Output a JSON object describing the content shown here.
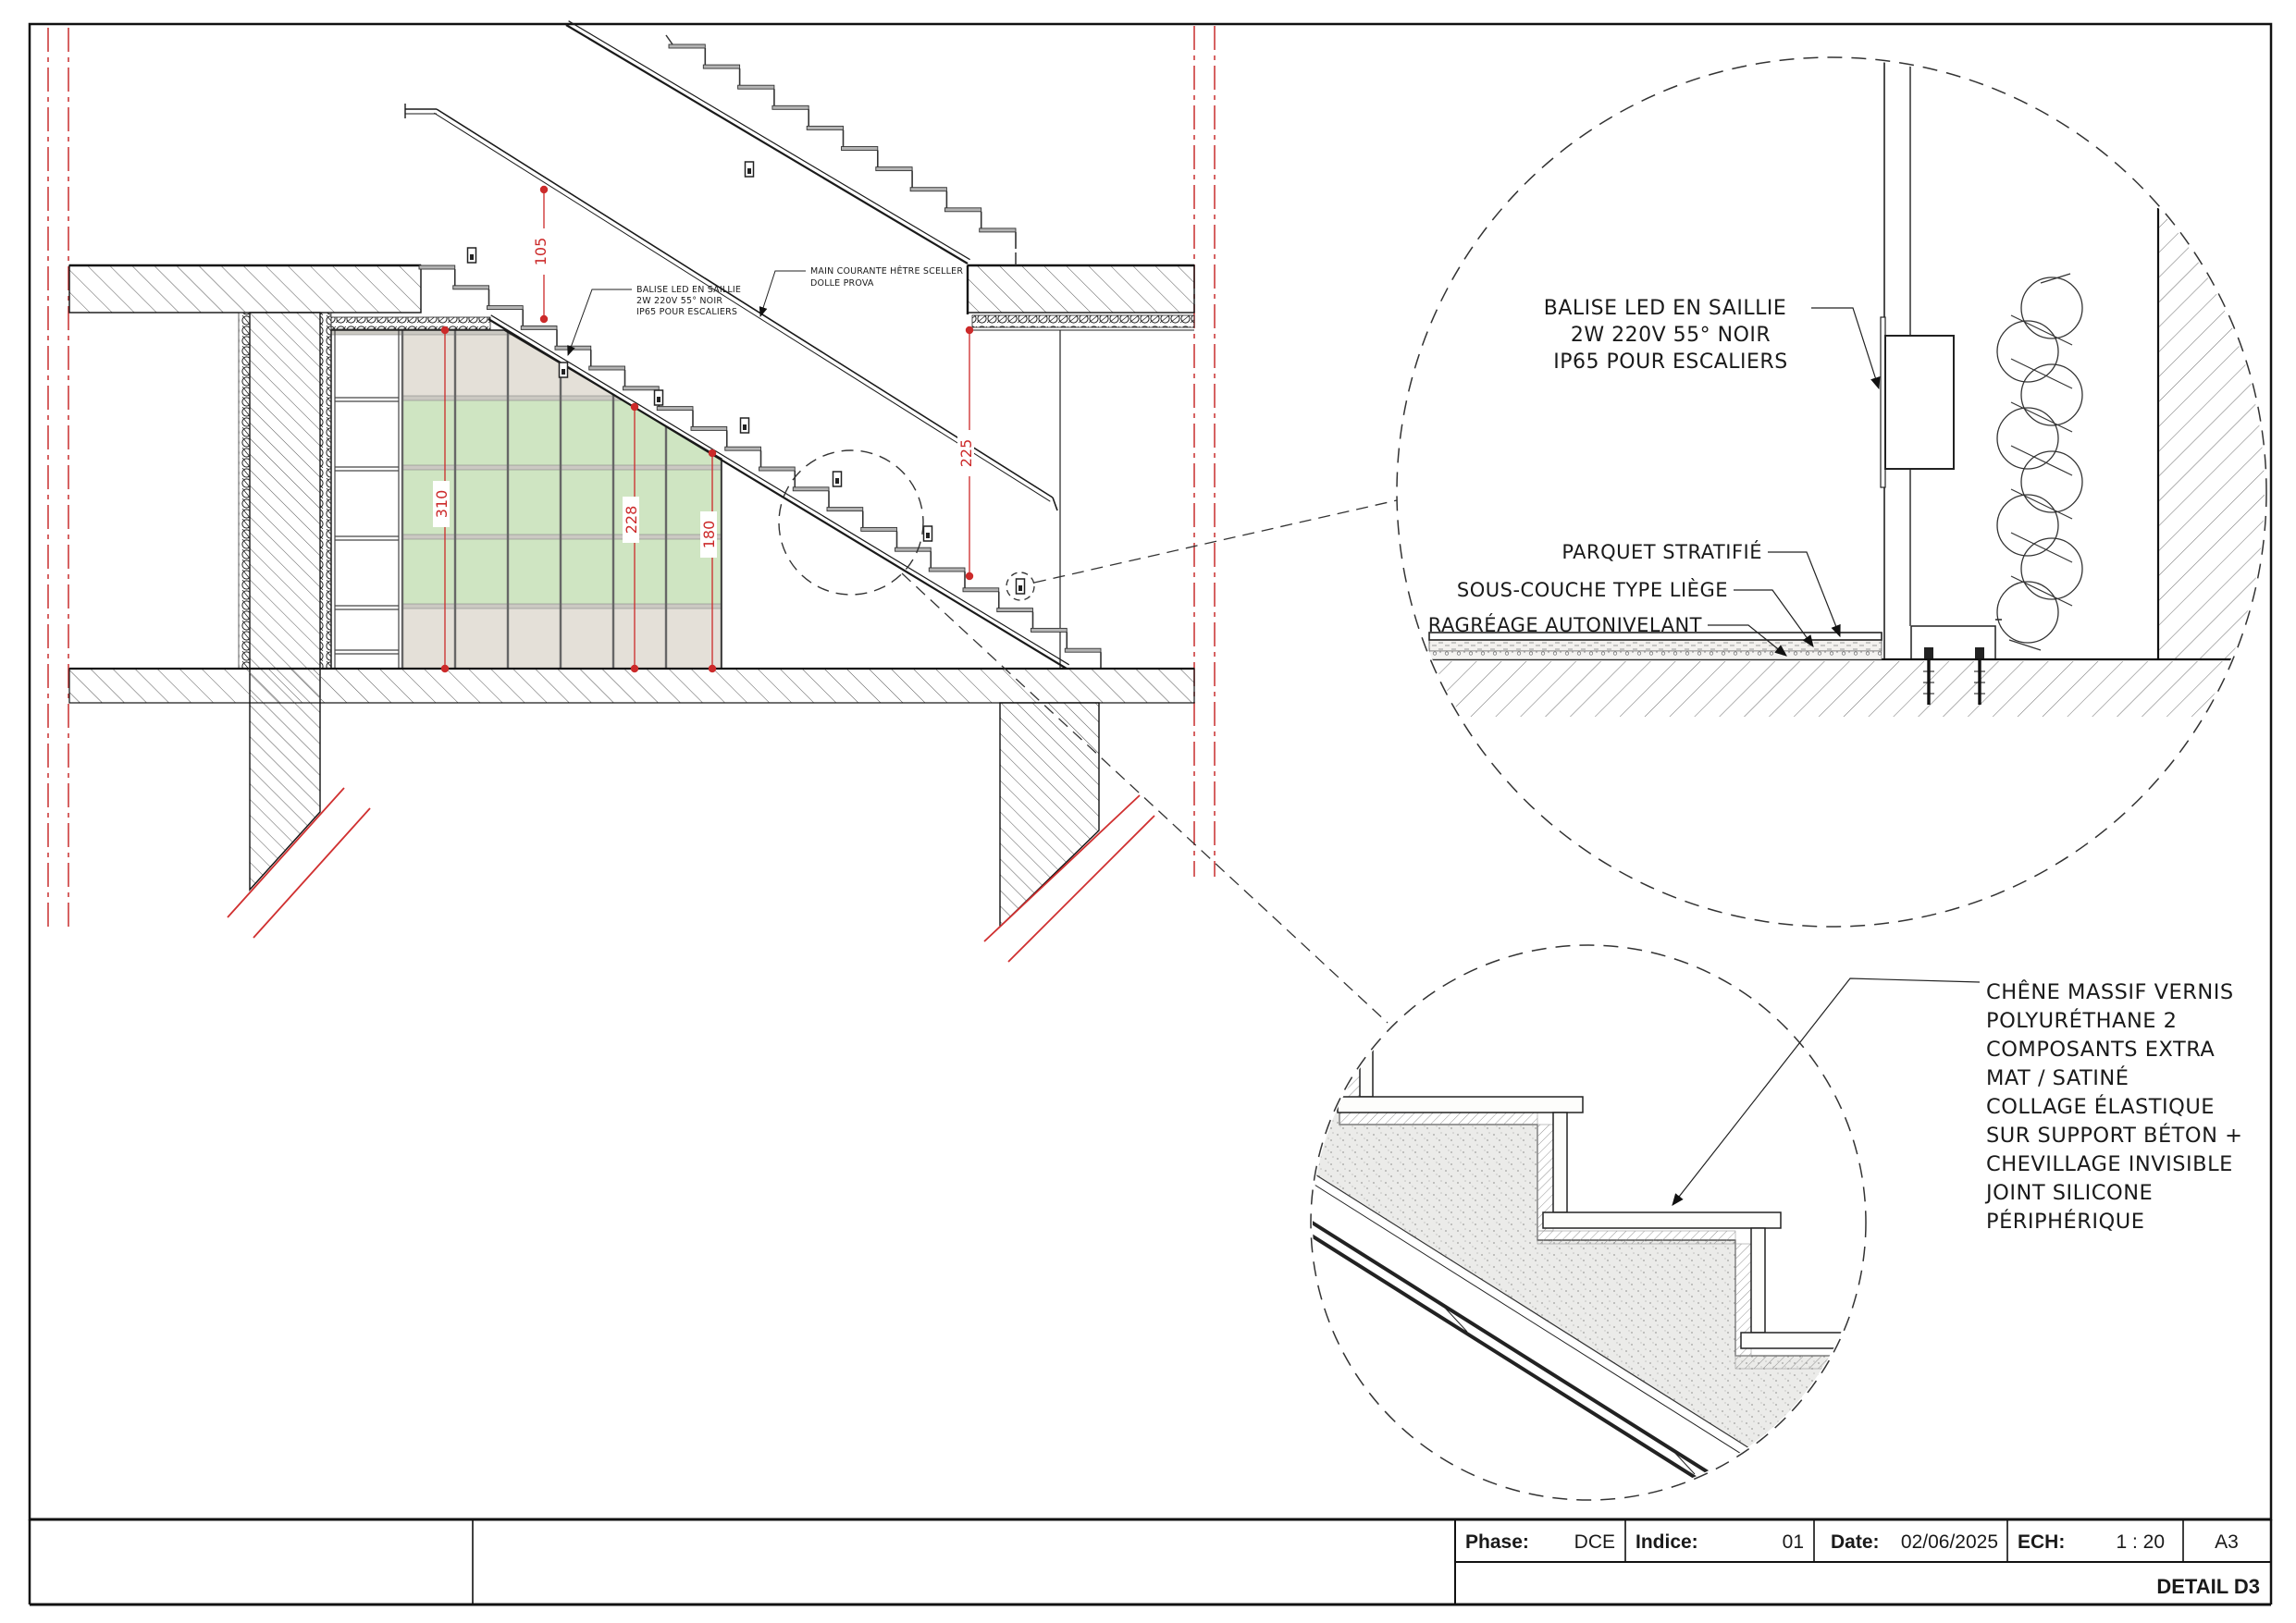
{
  "detail_top": {
    "balise_label": {
      "lines": [
        "BALISE LED EN SAILLIE",
        "2W 220V 55° NOIR",
        "IP65 POUR ESCALIERS"
      ]
    },
    "parquet_label": "PARQUET STRATIFIÉ",
    "sous_couche_label": "SOUS-COUCHE TYPE LIÈGE",
    "ragreage_label": "RAGRÉAGE AUTONIVELANT"
  },
  "detail_bottom": {
    "chene_label": {
      "lines": [
        "CHÊNE MASSIF VERNIS",
        "POLYURÉTHANE 2",
        "COMPOSANTS EXTRA",
        "MAT / SATINÉ",
        "COLLAGE ÉLASTIQUE",
        "SUR SUPPORT BÉTON +",
        "CHEVILLAGE INVISIBLE",
        "JOINT SILICONE",
        "PÉRIPHÉRIQUE"
      ]
    }
  },
  "section_notes": {
    "balise_note": {
      "lines": [
        "BALISE LED EN SAILLIE",
        "2W 220V 55° NOIR",
        "IP65 POUR ESCALIERS"
      ]
    },
    "main_courante_note": {
      "lines": [
        "MAIN COURANTE HÊTRE SCELLER",
        "DOLLE PROVA"
      ]
    }
  },
  "dimensions": {
    "d310": "310",
    "d228": "228",
    "d180": "180",
    "d105": "105",
    "d225": "225"
  },
  "title_block": {
    "phase_label": "Phase:",
    "phase_value": "DCE",
    "indice_label": "Indice:",
    "indice_value": "01",
    "date_label": "Date:",
    "date_value": "02/06/2025",
    "ech_label": "ECH:",
    "ech_value": "1 : 20",
    "format_value": "A3",
    "drawing_title": "DETAIL D3"
  },
  "colors": {
    "dimension_red": "#cc2a2a",
    "axis_red": "#cc3b3b",
    "glass_green": "#cfe5c2",
    "panel_grey": "#e4e0d8",
    "line_black": "#1a1a1a"
  }
}
